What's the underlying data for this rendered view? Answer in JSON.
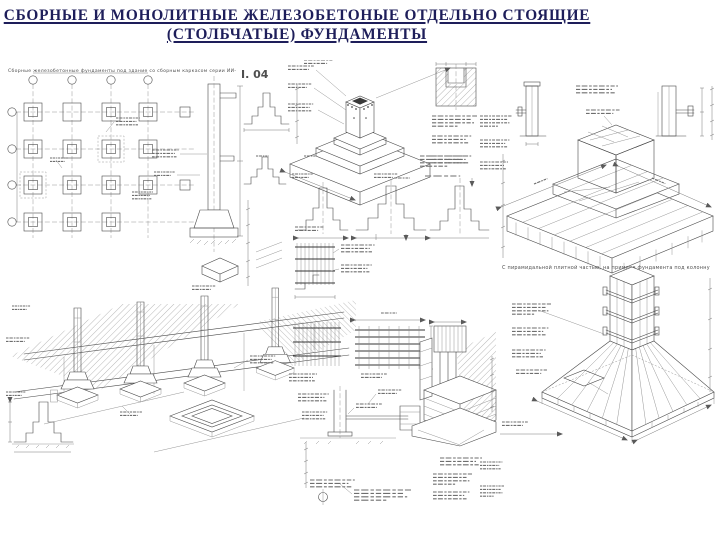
{
  "slide": {
    "title_line1": "СБОРНЫЕ И МОНОЛИТНЫЕ ЖЕЛЕЗОБЕТОНЫЕ  ОТДЕЛЬНО СТОЯЩИЕ",
    "title_line2": "(СТОЛБЧАТЫЕ) ФУНДАМЕНТЫ"
  },
  "colors": {
    "title_text": "#1e1e5a",
    "drawing_ink": "#4a4a4a",
    "paper": "#ffffff"
  },
  "panels": {
    "left": {
      "header_text": "Сборные железобетонные фундаменты под здание со сборным каркасом серии ИИ-",
      "series_label": "І. 04"
    },
    "right": {
      "caption": "С пирамидальной плитной частью, на примере фундамента под колонну"
    }
  }
}
